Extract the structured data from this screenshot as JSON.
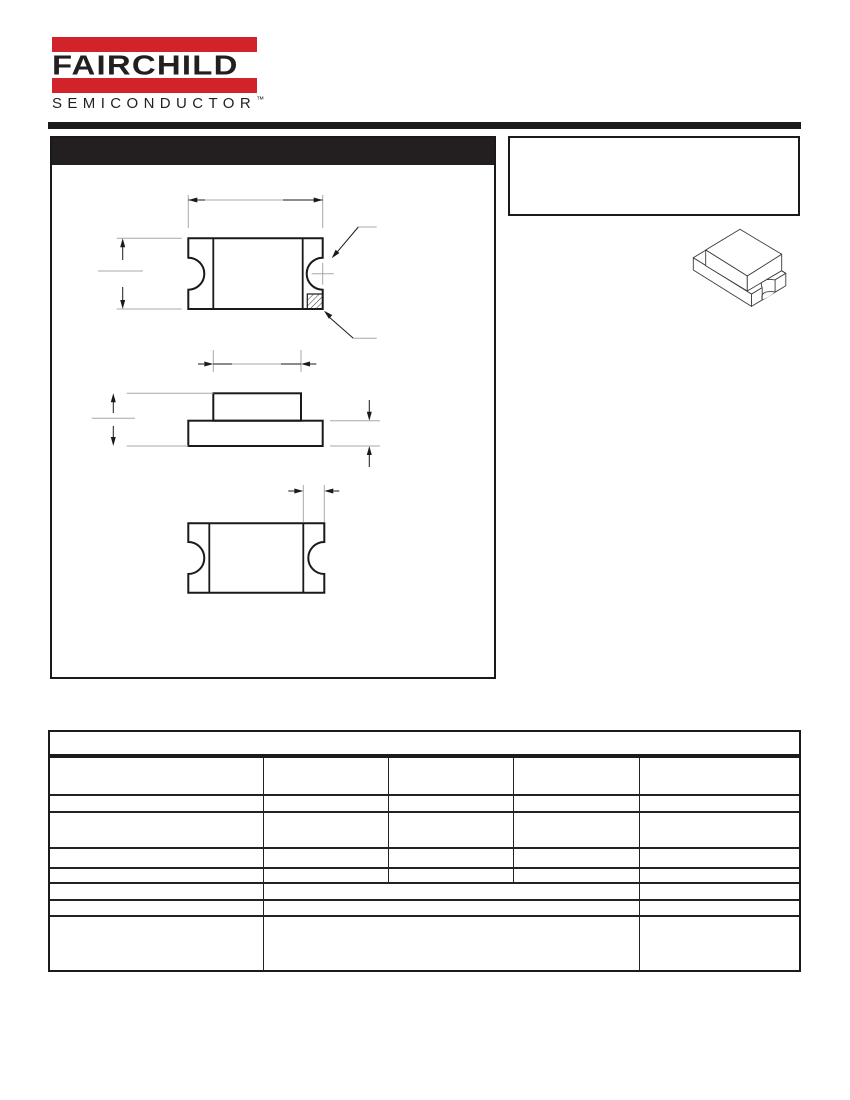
{
  "colors": {
    "brand_red": "#D2232A",
    "ink": "#231F20",
    "line": "#1A1A1A",
    "aux_line": "#A8A8A8",
    "page_background": "#FFFFFF"
  },
  "logo": {
    "brand": "FAIRCHILD",
    "subbrand": "SEMICONDUCTOR",
    "trademark": "™"
  },
  "left_panel": {
    "title": ""
  },
  "note_box": {
    "text": ""
  },
  "drawing": {
    "views": [
      "top-view",
      "side-view",
      "bottom-view",
      "isometric-view"
    ],
    "dimension_labels": [
      "",
      "",
      "",
      "",
      "",
      "",
      ""
    ]
  },
  "table": {
    "title": "",
    "header": [
      "",
      "",
      "",
      "",
      ""
    ],
    "rows": [
      {
        "cells": [
          "",
          "",
          "",
          "",
          ""
        ]
      },
      {
        "cells": [
          "",
          "",
          "",
          "",
          ""
        ]
      },
      {
        "cells": [
          "",
          "",
          "",
          "",
          ""
        ]
      },
      {
        "cells": [
          "",
          "",
          "",
          "",
          ""
        ]
      },
      {
        "cells": [
          "",
          "",
          ""
        ]
      },
      {
        "cells": [
          "",
          "",
          ""
        ]
      },
      {
        "cells": [
          "",
          "",
          ""
        ]
      }
    ]
  }
}
